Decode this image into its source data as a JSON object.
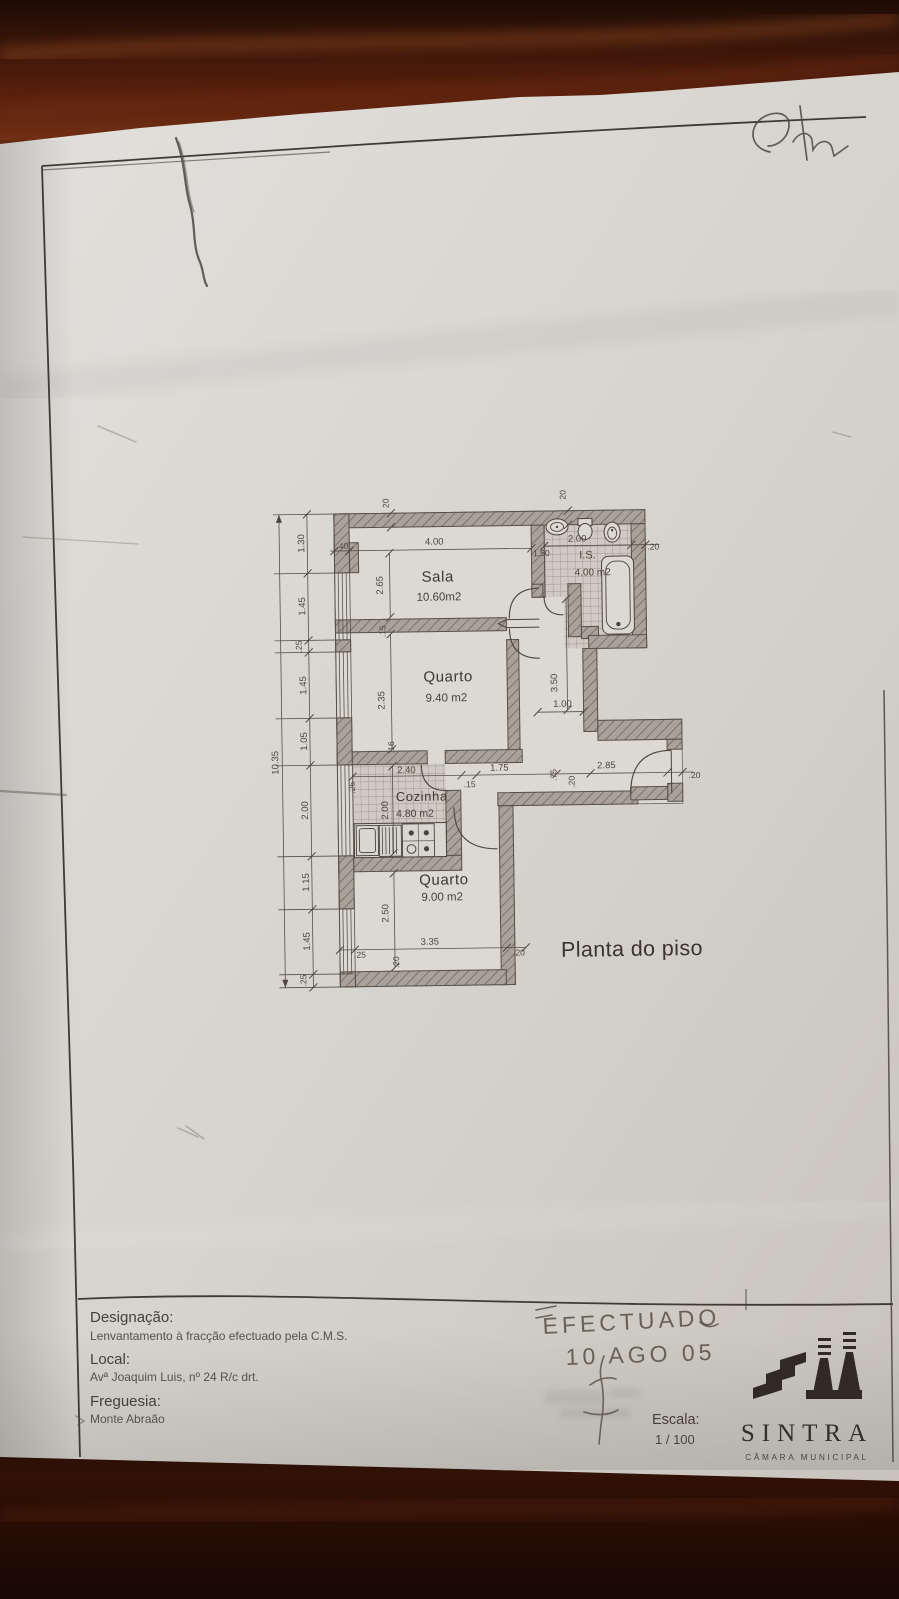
{
  "plan": {
    "title": "Planta do piso",
    "rooms": {
      "sala": {
        "name": "Sala",
        "area": "10.60m2"
      },
      "quarto1": {
        "name": "Quarto",
        "area": "9.40 m2"
      },
      "cozinha": {
        "name": "Cozinha",
        "area": "4.80 m2"
      },
      "quarto2": {
        "name": "Quarto",
        "area": "9.00 m2"
      },
      "is": {
        "name": "I.S.",
        "area": "4.00 m2"
      }
    },
    "dims": {
      "total_left": "10.35",
      "chain_left": [
        "1.30",
        "1.45",
        ".25",
        "1.45",
        "1.05",
        "2.00",
        "1.15",
        "1.45",
        ".25"
      ],
      "wall_top_left": "20",
      "wall_top_right": "20",
      "sala_width": "4.00",
      "corner": ".40",
      "sala_depth": "2.65",
      "wall_sala_quarto": ".15",
      "quarto1_depth": "2.35",
      "wall_quarto_cozinha": ".16",
      "bath_width": "2.00",
      "bath_inner": "1.50",
      "wall_bath_right": ".20",
      "hall_depth": "3.50",
      "hall_width": "1.00",
      "cozinha_width": "2.40",
      "cozinha_wall": ".26",
      "cozinha_depth": "2.00",
      "door_jamb": ".15",
      "corridor_1": "1.75",
      "corridor_2": ".75",
      "corridor_3": ".20",
      "corridor_4": "2.85",
      "corridor_5": ".20",
      "quarto2_depth": "2.50",
      "quarto2_width": "3.35",
      "bottom_left": ".25",
      "bottom_wall": ".20",
      "bottom_right": ".20"
    }
  },
  "title_block": {
    "designacao_label": "Designação:",
    "designacao_value": "Lenvantamento à fracção efectuado pela C.M.S.",
    "local_label": "Local:",
    "local_value": "Avª Joaquim Luis, nº 24 R/c drt.",
    "freguesia_label": "Freguesia:",
    "freguesia_value": "Monte Abraão",
    "escala_label": "Escala:",
    "escala_value": "1 / 100",
    "logo_name": "SINTRA",
    "logo_sub": "CÂMARA MUNICIPAL"
  },
  "handwriting": {
    "line1": "EFECTUADO",
    "line2": "10 AGO 05"
  },
  "colors": {
    "paper": "#d6d3cd",
    "wood_dark": "#2a0e05",
    "wood_mid": "#6e2c12",
    "ink": "#3f3a33"
  }
}
